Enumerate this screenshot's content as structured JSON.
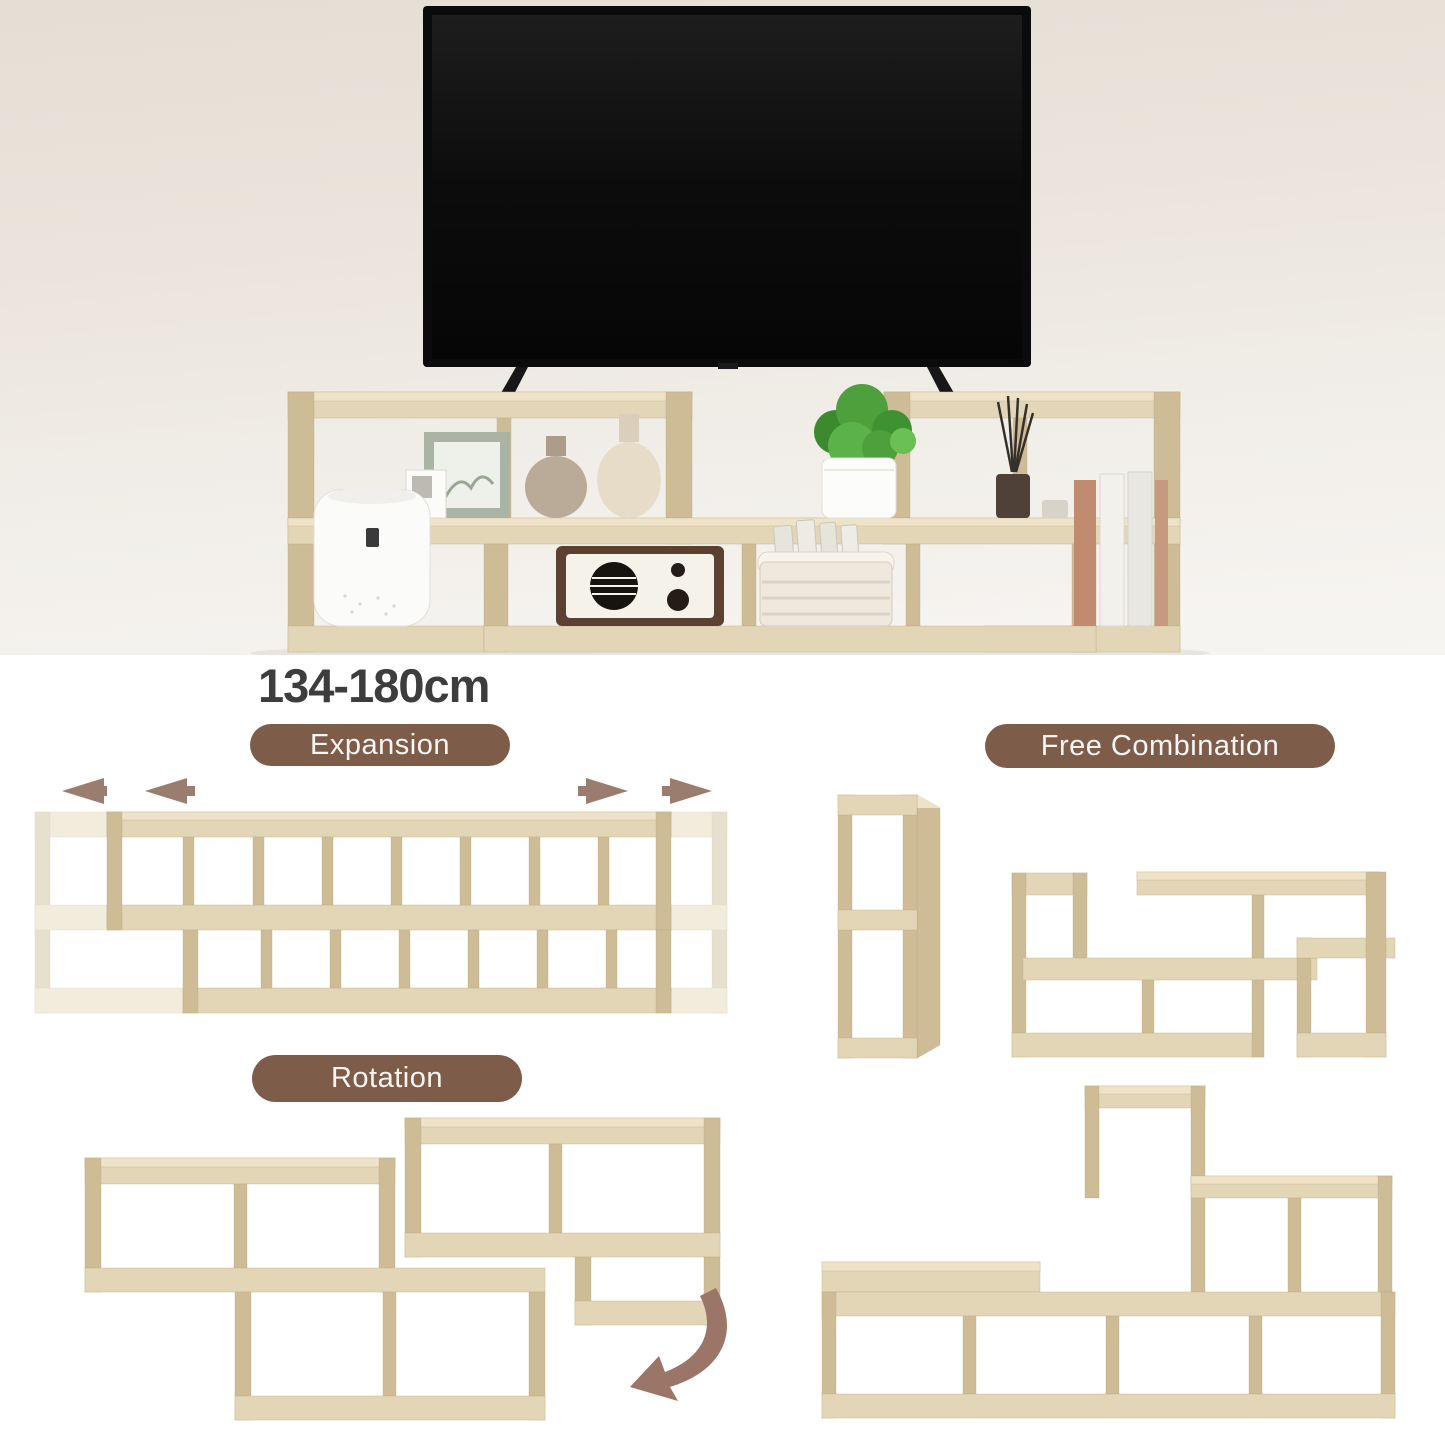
{
  "dimension_label": "134-180cm",
  "sections": {
    "expansion": {
      "label": "Expansion"
    },
    "free_combination": {
      "label": "Free Combination"
    },
    "rotation": {
      "label": "Rotation"
    }
  },
  "hero": {
    "decor_items": [
      "tv",
      "shelf-unit",
      "picture-frame",
      "photo-card",
      "small-vase",
      "tall-vase",
      "potted-plant",
      "reed-diffuser",
      "scented-candle",
      "books",
      "air-purifier",
      "retro-radio",
      "storage-basket"
    ]
  },
  "icons": [
    "expand-left-arrows-icon",
    "expand-right-arrows-icon",
    "rotate-arrow-icon"
  ],
  "colors": {
    "hero_background_top": "#e5ded4",
    "hero_background_bottom": "#f7f5f2",
    "section_background": "#ffffff",
    "wood_face": "#e3d6b6",
    "wood_top": "#eee3c8",
    "wood_shade": "#cdbc96",
    "badge_background": "#7d5c4a",
    "badge_text": "#f8f5f2",
    "heading_text": "#3d3d3d",
    "arrow": "#9b7668",
    "tv": "#0b0b0b"
  }
}
